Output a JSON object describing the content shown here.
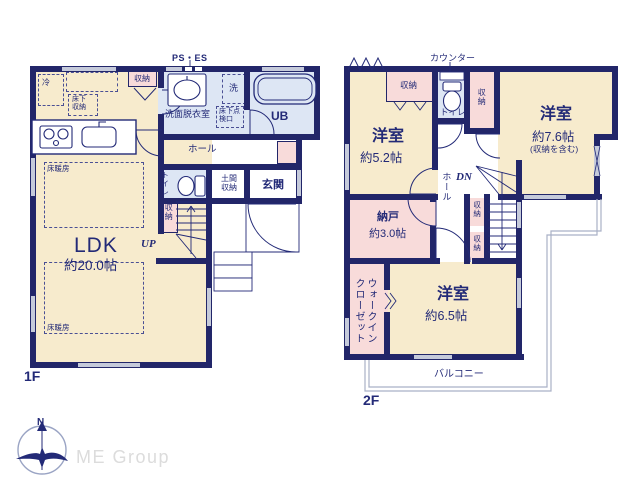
{
  "floor1": {
    "label": "1F",
    "annotations": {
      "ps_es": "PS・ES",
      "up": "UP"
    },
    "rooms": {
      "ldk": {
        "name": "LDK",
        "area": "約20.0帖"
      },
      "washroom": {
        "name": "洗面脱衣室"
      },
      "washer": {
        "name": "洗"
      },
      "ub": {
        "name": "UB"
      },
      "hall": {
        "name": "ホール"
      },
      "toilet": {
        "name": "トイレ"
      },
      "doma": {
        "name": "土間収納"
      },
      "entrance": {
        "name": "玄関"
      },
      "storage_top": {
        "name": "収納"
      },
      "storage_stair": {
        "name": "収納"
      },
      "fridge": {
        "name": "冷"
      },
      "underfloor_storage": {
        "name": "床下収納"
      },
      "underfloor_hatch": {
        "name": "床下点検口"
      },
      "floor_heating": {
        "name": "床暖房"
      }
    }
  },
  "floor2": {
    "label": "2F",
    "annotations": {
      "counter": "カウンター",
      "dn": "DN"
    },
    "rooms": {
      "bedroom52": {
        "name": "洋室",
        "area": "約5.2帖"
      },
      "bedroom76": {
        "name": "洋室",
        "area": "約7.6帖",
        "note": "(収納を含む)"
      },
      "bedroom65": {
        "name": "洋室",
        "area": "約6.5帖"
      },
      "storeroom": {
        "name": "納戸",
        "area": "約3.0帖"
      },
      "wic": {
        "name": "ウォークインクローゼット"
      },
      "hall": {
        "name": "ホール"
      },
      "toilet": {
        "name": "トイレ"
      },
      "storage52": {
        "name": "収納"
      },
      "storage76": {
        "name": "収納"
      },
      "storage_stair_a": {
        "name": "収納"
      },
      "storage_stair_b": {
        "name": "収納"
      },
      "balcony": {
        "name": "バルコニー"
      }
    }
  },
  "footer": {
    "brand": "ME Group",
    "compass_north": "N"
  },
  "colors": {
    "wall": "#222669",
    "room_fill": "#f7ebcd",
    "storage_fill": "#f8dbda",
    "wet_fill": "#dde6f4",
    "window": "#c5cada",
    "balcony_line": "#a9b0c6",
    "brand_text": "#dcdcdc",
    "text": "#232a77"
  }
}
